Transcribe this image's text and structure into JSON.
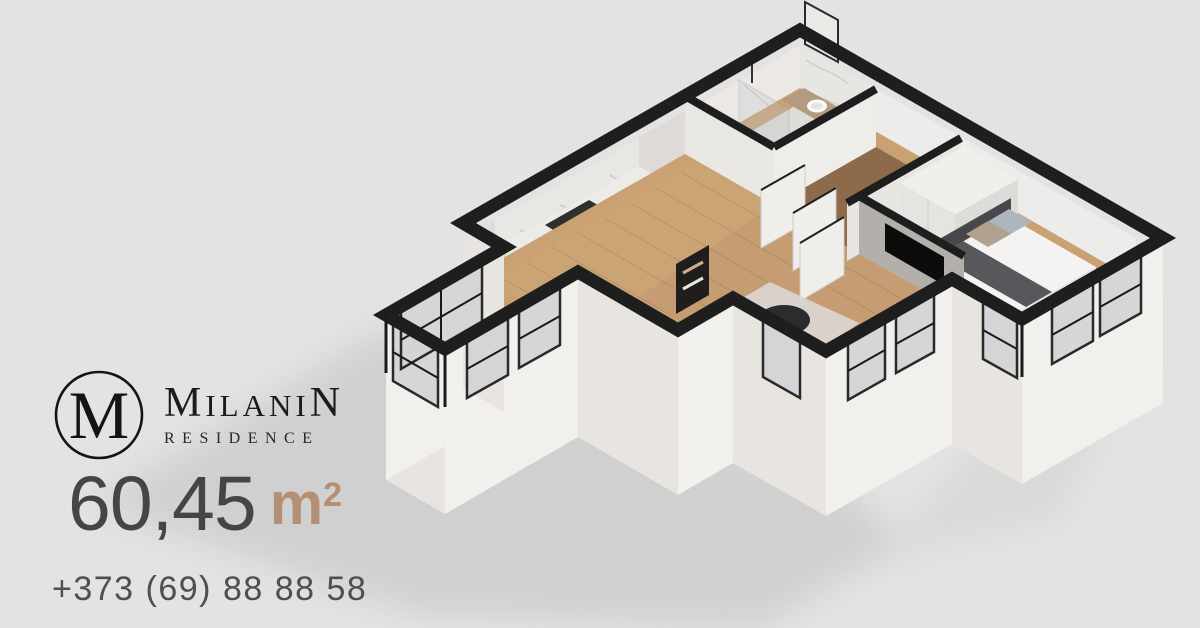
{
  "brand": {
    "monogram": "M",
    "name_first": "M",
    "name_mid": "ILANI",
    "name_last": "N",
    "subtitle": "RESIDENCE"
  },
  "listing": {
    "area_value": "60,45",
    "area_unit": "m",
    "area_exponent": "2"
  },
  "contact": {
    "phone": "+373 (69) 88 88 58"
  },
  "palette": {
    "background": "#e3e3e3",
    "wall_cap": "#1e1e1e",
    "wall_light": "#f1efeb",
    "wall_shaded": "#e8e5e1",
    "floor_wood": "#c9a173",
    "floor_wood_dark": "#8d6b4a",
    "marble": "#e8e6e2",
    "glass": "#d3d4d6",
    "accent_tan": "#b58f73",
    "text_dark": "#454545",
    "text_gray": "#4f4f4f"
  },
  "floorplan_rooms": [
    "kitchen",
    "dining",
    "living-room",
    "bedroom",
    "bathroom",
    "hallway"
  ]
}
